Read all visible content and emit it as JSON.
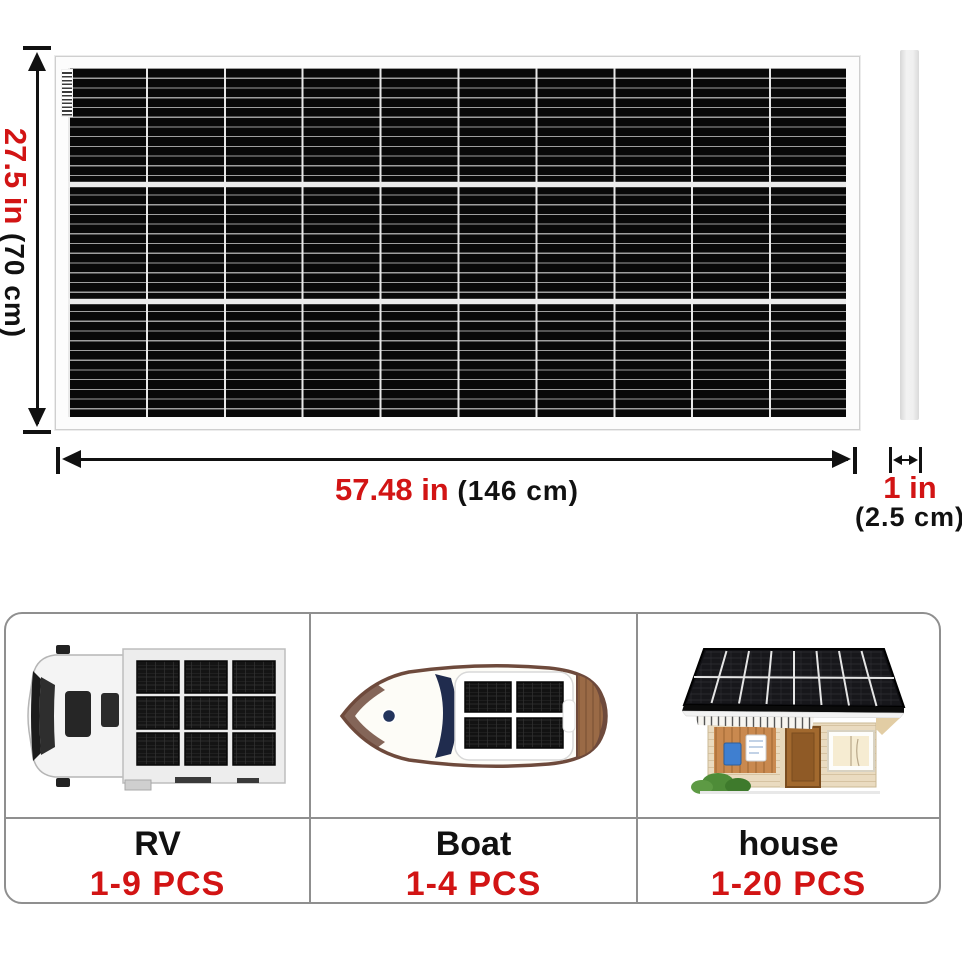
{
  "dimensions": {
    "height": {
      "imperial": "27.5 in",
      "metric": "(70 cm)"
    },
    "width": {
      "imperial": "57.48 in",
      "metric": "(146 cm)"
    },
    "thickness": {
      "imperial": "1 in",
      "metric": "(2.5 cm)"
    }
  },
  "applications": {
    "columns": [
      {
        "label": "RV",
        "quantity": "1-9 PCS",
        "icon": "rv-top-view-icon"
      },
      {
        "label": "Boat",
        "quantity": "1-4 PCS",
        "icon": "boat-top-view-icon"
      },
      {
        "label": "house",
        "quantity": "1-20 PCS",
        "icon": "house-solar-roof-icon"
      }
    ]
  },
  "icons": {
    "panel_front": "solar-panel-front-view",
    "panel_side": "solar-panel-side-profile"
  },
  "colors": {
    "accent_red": "#d21414",
    "text_black": "#111111",
    "card_border": "#8f8f8f",
    "panel_black": "#0a0a0a"
  }
}
